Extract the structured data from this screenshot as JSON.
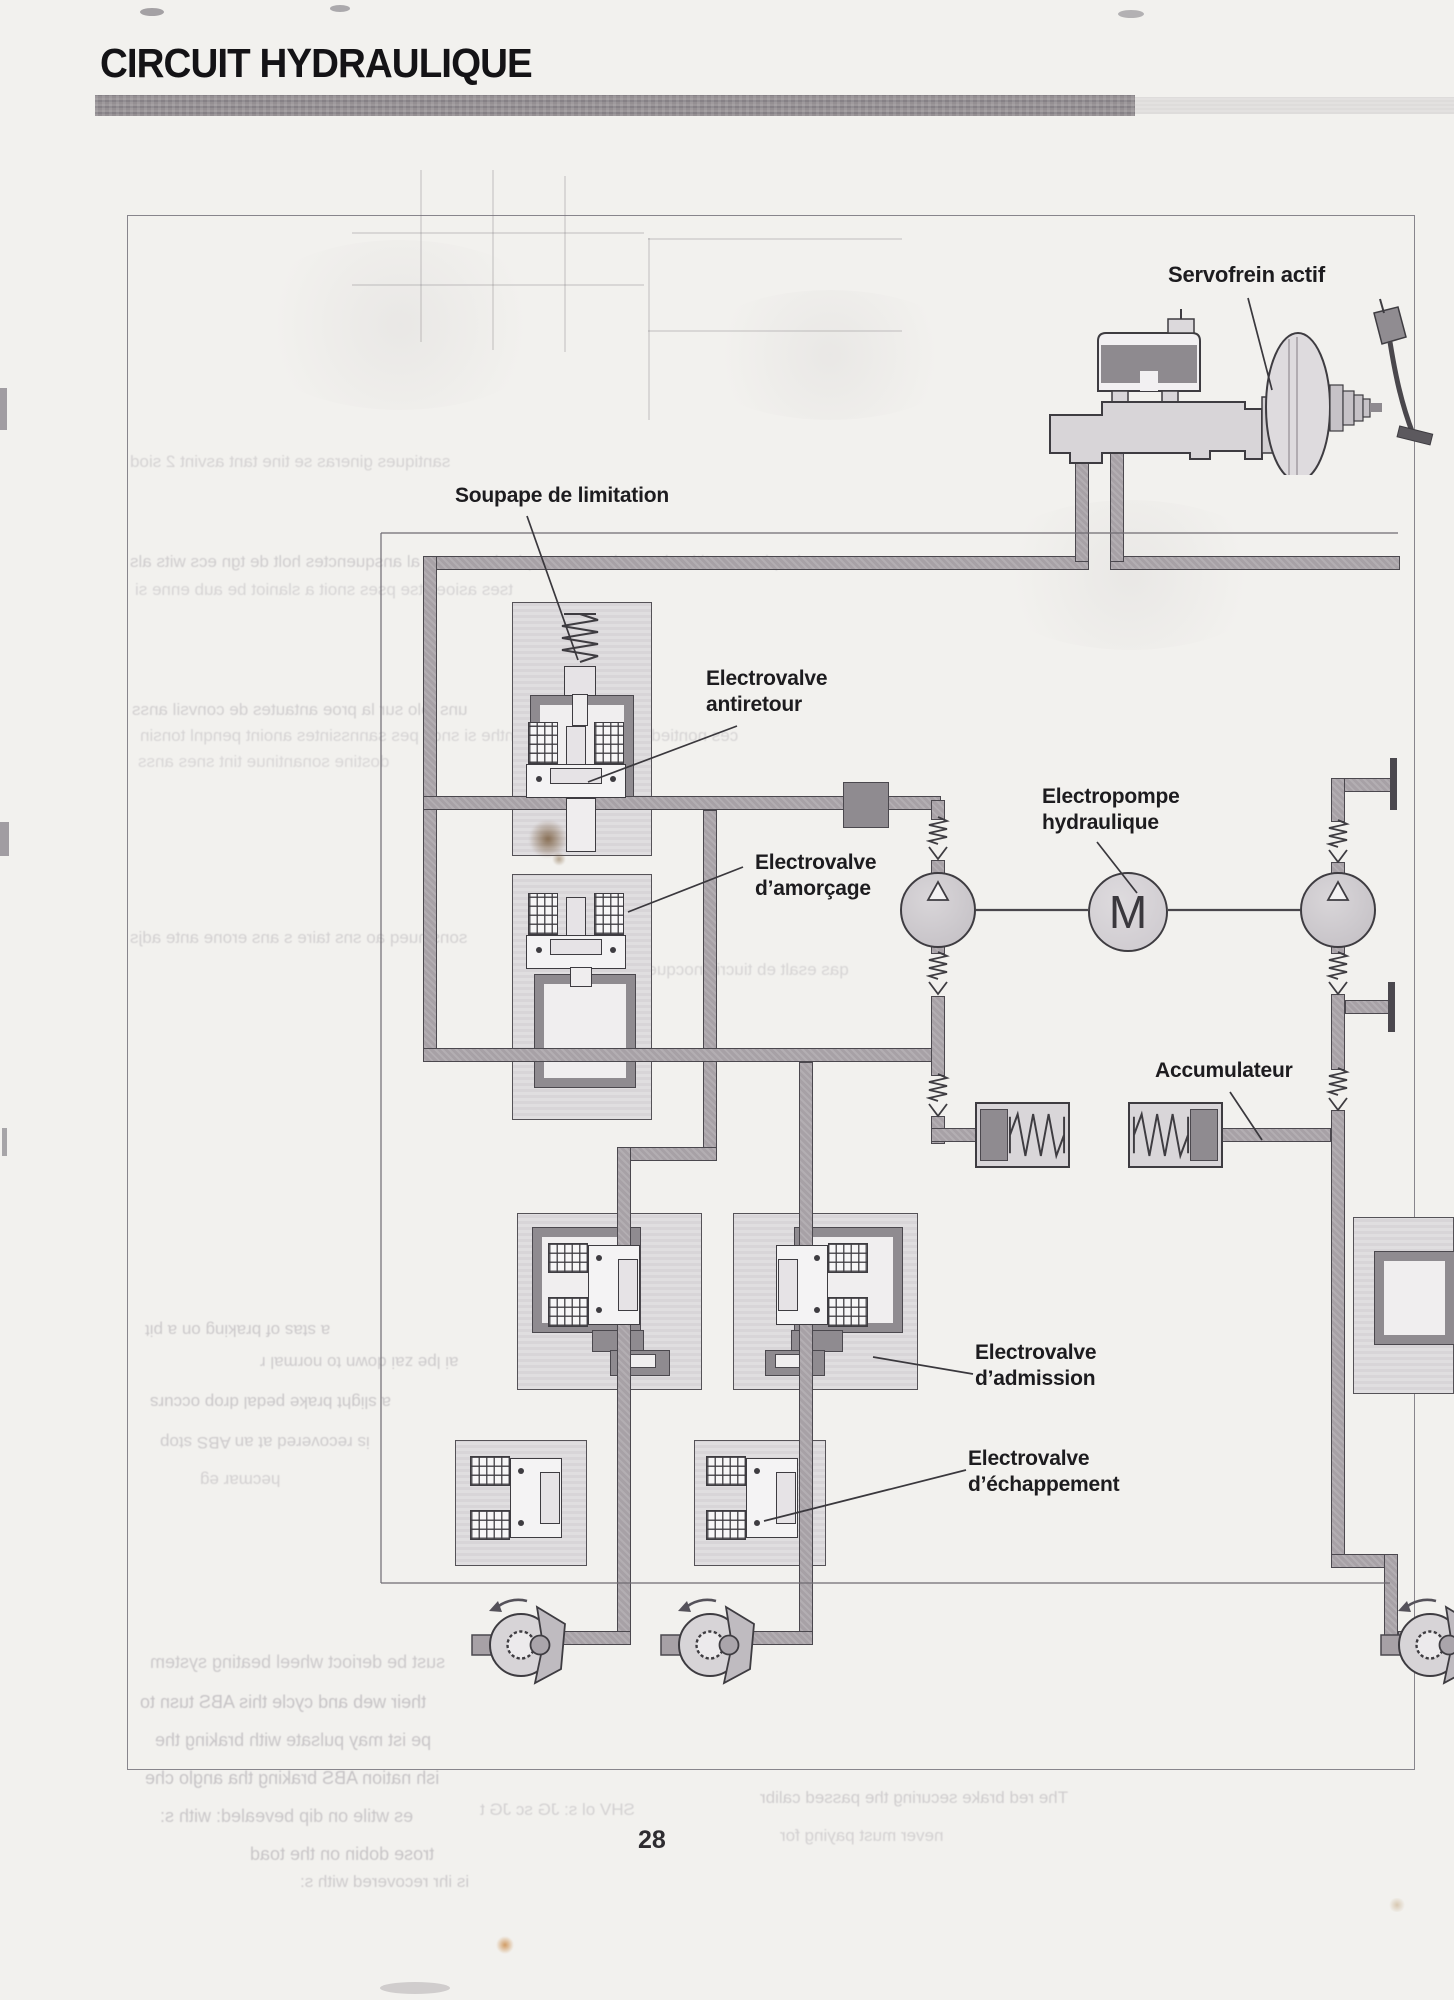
{
  "page": {
    "title": "CIRCUIT HYDRAULIQUE",
    "page_number": "28",
    "background_color": "#f2f1ee",
    "header_bar_color": "#8f8a8c"
  },
  "diagram": {
    "labels": {
      "servofrein": "Servofrein actif",
      "soupape": "Soupape de limitation",
      "antiretour_1": "Electrovalve",
      "antiretour_2": "antiretour",
      "amorcage_1": "Electrovalve",
      "amorcage_2": "d’amorçage",
      "pompe_1": "Electropompe",
      "pompe_2": "hydraulique",
      "accumulateur": "Accumulateur",
      "admission_1": "Electrovalve",
      "admission_2": "d’admission",
      "echappement_1": "Electrovalve",
      "echappement_2": "d’échappement",
      "motor_letter": "M"
    },
    "colors": {
      "pipe": "#a7a1a6",
      "pipe_border": "#4b484e",
      "component_fill": "#dcd9dc",
      "channel_dark": "#8f8b90",
      "label_text": "#1d1c1f"
    },
    "symbols": [
      "check-valve",
      "pump",
      "electric-motor",
      "accumulator",
      "filter",
      "solenoid-valve",
      "brake-caliper",
      "master-cylinder",
      "brake-booster",
      "spring",
      "brake-pedal"
    ]
  },
  "ghost": {
    "mid": [
      "santiques gineras se tine tant asvint 2 siod",
      "avoc steint pinson a titine le condtest anoss pla dne conne al ansquenctes holt de tgn ecs wits als",
      "tses asioes tse pses snoit a slaniot be aub enne si",
      "uns tolo sur la proe antautes de convsil anss",
      "ces nontied ne tienne li pes dinthe si snoit pes sannssintes anoint penqnl tonsin",
      "dostine  sonantinue tint snes anss",
      "sonsinueq ao sns taire s ans erone  ante adjs",
      "qas esalt eb tiucris nocquesne"
    ],
    "flipped": [
      "a stas of braking on a pit",
      "ai lpe zai down to normal r",
      "a slight brake pedal drop occurs",
      "is recovered at an ABS stop",
      "hecmar eg"
    ],
    "bottom": [
      "sust be derioct wheel beating system",
      "their web and cycle this ABS tusn to",
      "pe ist may pulsate with braking the",
      "ish nation ABS braking tha anglo che",
      "es wtile on dip bevealed: with s:",
      "trose dobin on the toad",
      "is ihr recovered with s:",
      "The red brake  securing the  passed calibr",
      "never must paying for",
      "SHV    ol s:    JG sc    JG t"
    ]
  }
}
